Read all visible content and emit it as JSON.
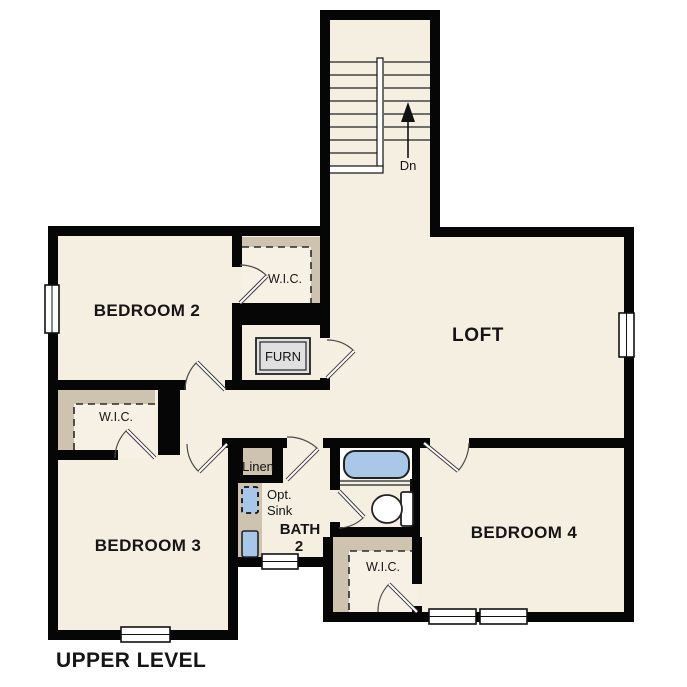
{
  "plan_title": "UPPER LEVEL",
  "labels": {
    "bedroom2": "BEDROOM 2",
    "bedroom3": "BEDROOM 3",
    "bedroom4": "BEDROOM 4",
    "loft": "LOFT",
    "wic": "W.I.C.",
    "furnace": "FURN",
    "linen": "Linen",
    "opt_sink_line1": "Opt.",
    "opt_sink_line2": "Sink",
    "bath_line1": "BATH",
    "bath_line2": "2",
    "stair_direction": "Dn"
  },
  "colors": {
    "floor": "#f5efe2",
    "wall": "#060606",
    "closet_shading": "#cdc3ae",
    "fixture_blue": "#a9c7e6",
    "sink_blue": "#a8c6e8",
    "furnace_gray": "#e0e0e0",
    "outside": "#ffffff"
  }
}
